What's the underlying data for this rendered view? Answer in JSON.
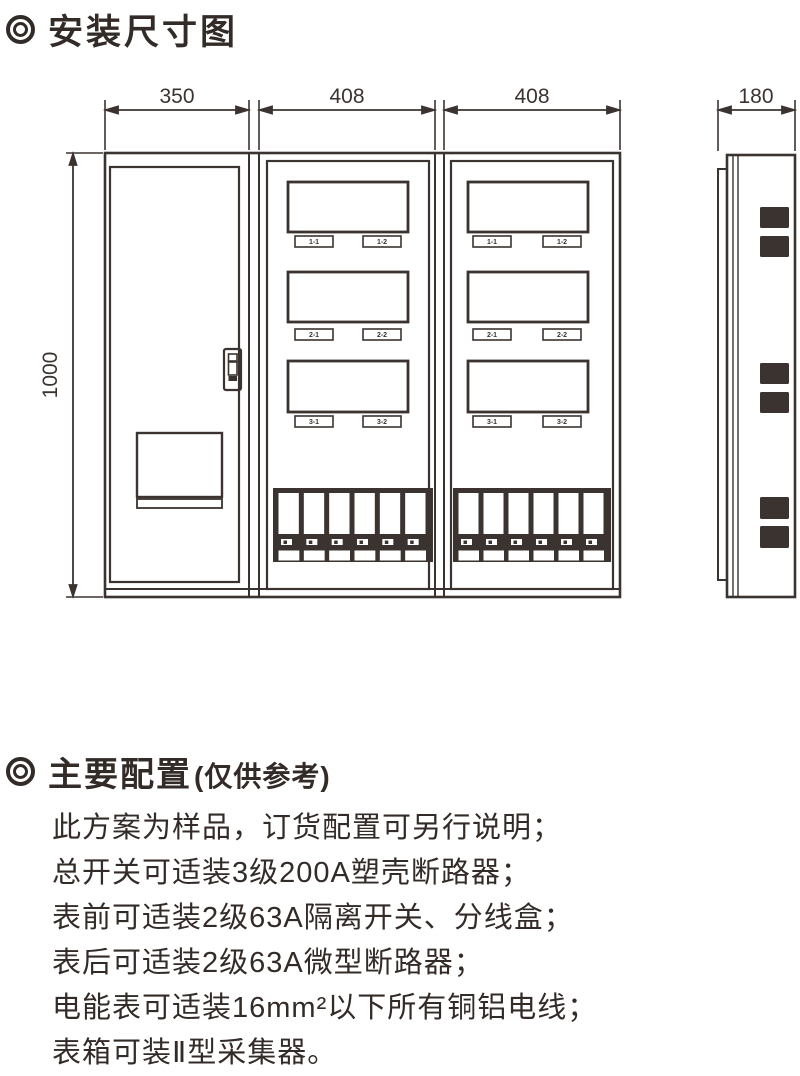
{
  "colors": {
    "line": "#3b3330",
    "text": "#332b28"
  },
  "section1": {
    "bullet_icon": "double-circle",
    "title": "安装尺寸图"
  },
  "diagram": {
    "dimensions": {
      "front_left": "350",
      "front_middle": "408",
      "front_right": "408",
      "side": "180",
      "height": "1000"
    },
    "meter_tags": [
      "1-1",
      "1-2",
      "2-1",
      "2-2",
      "3-1",
      "3-2"
    ]
  },
  "section2": {
    "bullet_icon": "double-circle",
    "title": "主要配置",
    "subtitle": "(仅供参考)",
    "lines": [
      "此方案为样品，订货配置可另行说明；",
      "总开关可适装3级200A塑壳断路器；",
      "表前可适装2级63A隔离开关、分线盒；",
      "表后可适装2级63A微型断路器；",
      "电能表可适装16mm²以下所有铜铝电线；",
      "表箱可装Ⅱ型采集器。"
    ]
  }
}
